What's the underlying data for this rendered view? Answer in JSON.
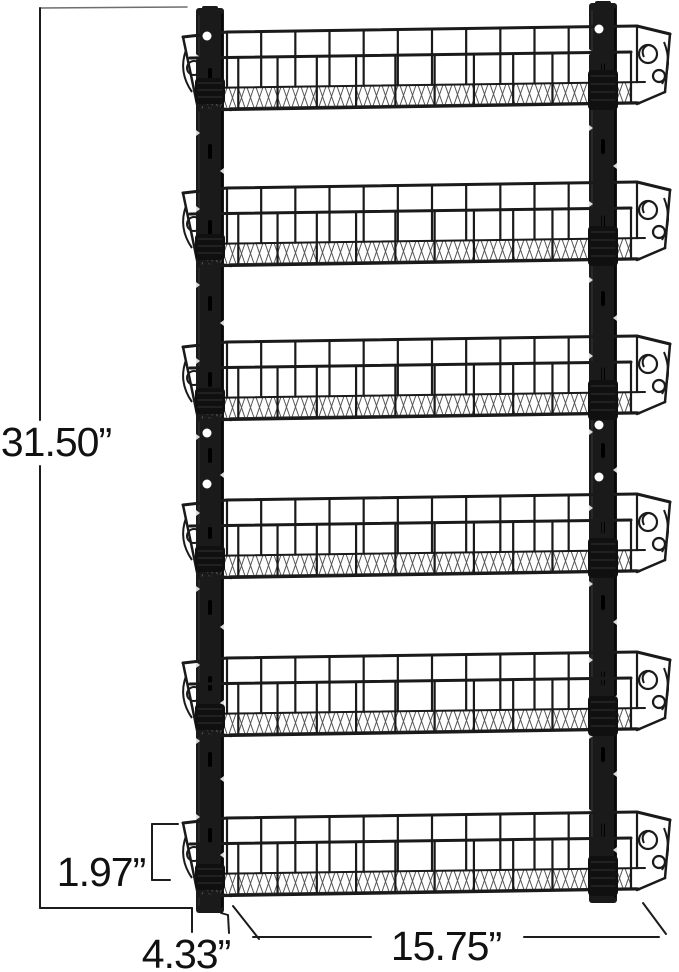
{
  "title": "6-tier wall mounted basket rack dimension diagram",
  "colors": {
    "background": "#ffffff",
    "metal": "#1a1a1a",
    "metal_soft": "#2e2e2e",
    "mesh": "#575757",
    "dimension_line": "#1c1c1c",
    "extension_line": "#6e6e6e",
    "hole": "#ffffff",
    "text": "#111111"
  },
  "product": {
    "tier_count": 6,
    "basket_rim_y": [
      30,
      186,
      340,
      498,
      656,
      816
    ],
    "left_rail": {
      "x": 196,
      "top": 8,
      "bottom": 913,
      "width": 28,
      "hole_x": 207,
      "holes_y": [
        36,
        433,
        484
      ]
    },
    "right_rail": {
      "x": 589,
      "top": 3,
      "bottom": 903,
      "width": 28,
      "hole_x": 599,
      "holes_y": [
        29,
        425,
        477
      ]
    }
  },
  "dimensions": {
    "overall_height": {
      "label": "31.50”"
    },
    "basket_height": {
      "label": "1.97”"
    },
    "side_depth": {
      "label": "4.33”"
    },
    "basket_width": {
      "label": "15.75”"
    }
  }
}
